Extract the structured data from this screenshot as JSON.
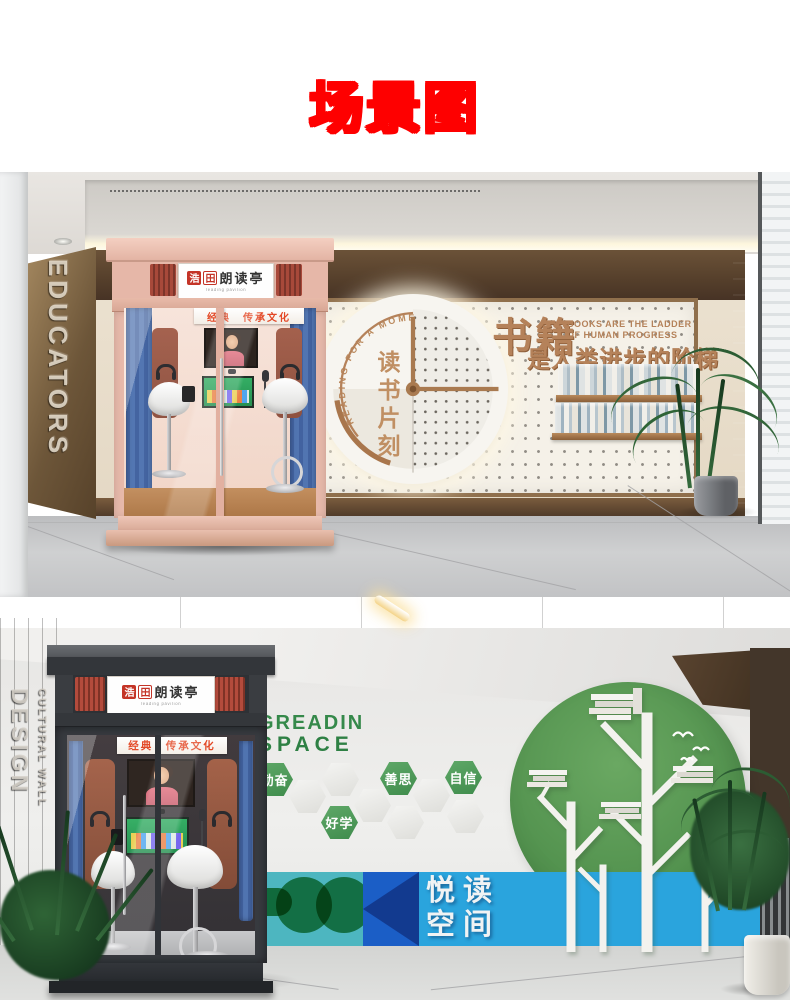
{
  "title": {
    "text": "场景图"
  },
  "colors": {
    "title_fill": "#ffe100",
    "title_outline": "#fe0000",
    "copper": "#b5825a",
    "booth1_pink": "#e9bcad",
    "booth2_charcoal": "#383b40",
    "sign_red": "#c43427",
    "banner_red": "#e2401c",
    "green_accent": "#3f8c4c",
    "teal_band": "#4db6c0",
    "blue_band": "#2aa4dd",
    "royal_blue": "#1b5ec6",
    "navy": "#123a8f",
    "curtain_blue": "#3f62a8"
  },
  "scene1": {
    "side_wall": {
      "vertical_text": "EDUCATORS"
    },
    "booth": {
      "logo_char_1": "浩",
      "logo_char_2": "田",
      "name": "朗读亭",
      "name_sub": "reading pavilion",
      "banner": "经典　传承文化"
    },
    "clock": {
      "curved_text": "READING FOR A MOMENT",
      "center_text": "读书片刻"
    },
    "slogan": {
      "heading": "书籍",
      "en_line1": "BOOKS ARE THE LADDER",
      "en_line2": "OF HUMAN PROGRESS",
      "cn_line": "是人类进步的阶梯"
    }
  },
  "scene2": {
    "side_wall": {
      "vertical_text_large": "DESIGN",
      "vertical_text_small": "CULTURAL WALL"
    },
    "booth": {
      "logo_char_1": "浩",
      "logo_char_2": "田",
      "name": "朗读亭",
      "name_sub": "reading pavilion",
      "banner": "经典　传承文化"
    },
    "wall_title": {
      "line1": "GREADIN",
      "line2": "SPACE"
    },
    "hexagons": [
      "勤奋",
      "好学",
      "善思",
      "自信"
    ],
    "band": {
      "line1": "悦读",
      "line2": "空间"
    }
  }
}
